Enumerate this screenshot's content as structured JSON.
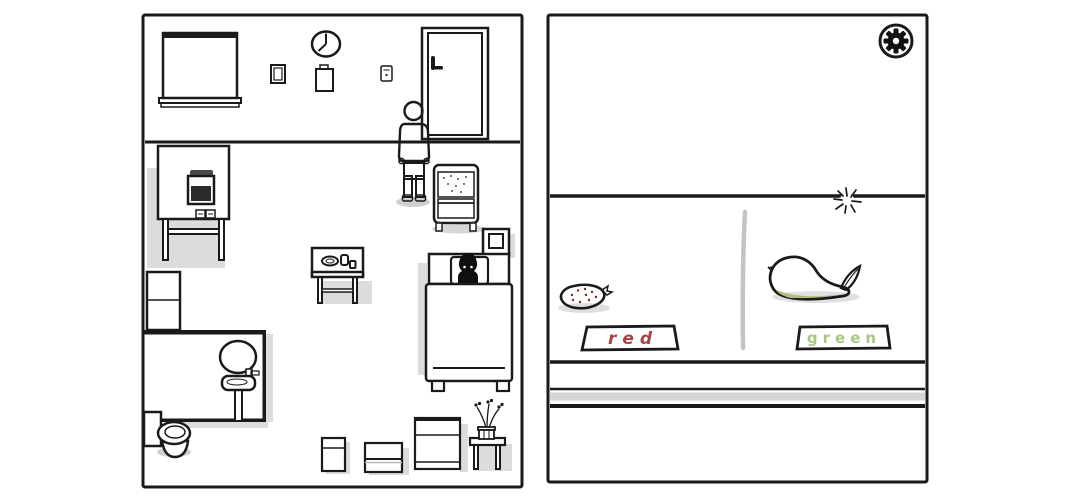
{
  "left_room": {
    "wall_items": [
      {
        "name": "roller-blind-window"
      },
      {
        "name": "wall-clock",
        "time": "7:00"
      },
      {
        "name": "picture-frame"
      },
      {
        "name": "clipboard"
      },
      {
        "name": "light-switch"
      },
      {
        "name": "door"
      }
    ],
    "furniture": [
      {
        "name": "medical-machine-on-table"
      },
      {
        "name": "tall-cabinet"
      },
      {
        "name": "bathroom-mirror"
      },
      {
        "name": "pedestal-sink"
      },
      {
        "name": "toilet"
      },
      {
        "name": "side-table-with-meal"
      },
      {
        "name": "serving-cart"
      },
      {
        "name": "nightstand"
      },
      {
        "name": "bed-with-sleeping-figure"
      },
      {
        "name": "small-box"
      },
      {
        "name": "wide-box"
      },
      {
        "name": "dresser"
      },
      {
        "name": "plant-table"
      }
    ],
    "character": {
      "name": "man-standing-at-door",
      "shirt_color": "#f4c95f",
      "pants_color": "#8497a5",
      "skin_color": "#8a6850"
    }
  },
  "right_table": {
    "settings_button": {
      "icon": "gear"
    },
    "sparkle_icon": "starburst",
    "divider_color": "#c4c4c4",
    "items": [
      {
        "name": "strawberry",
        "color": "#e05f3a"
      },
      {
        "name": "pear",
        "color": "#c3cf92"
      }
    ],
    "labels": [
      {
        "text": "red",
        "color": "#a94445"
      },
      {
        "text": "green",
        "color": "#a6c87e"
      }
    ]
  },
  "colors": {
    "ink": "#1a1a1a",
    "shadow": "#dcdcdc",
    "table_band": "#d6d6d6"
  }
}
